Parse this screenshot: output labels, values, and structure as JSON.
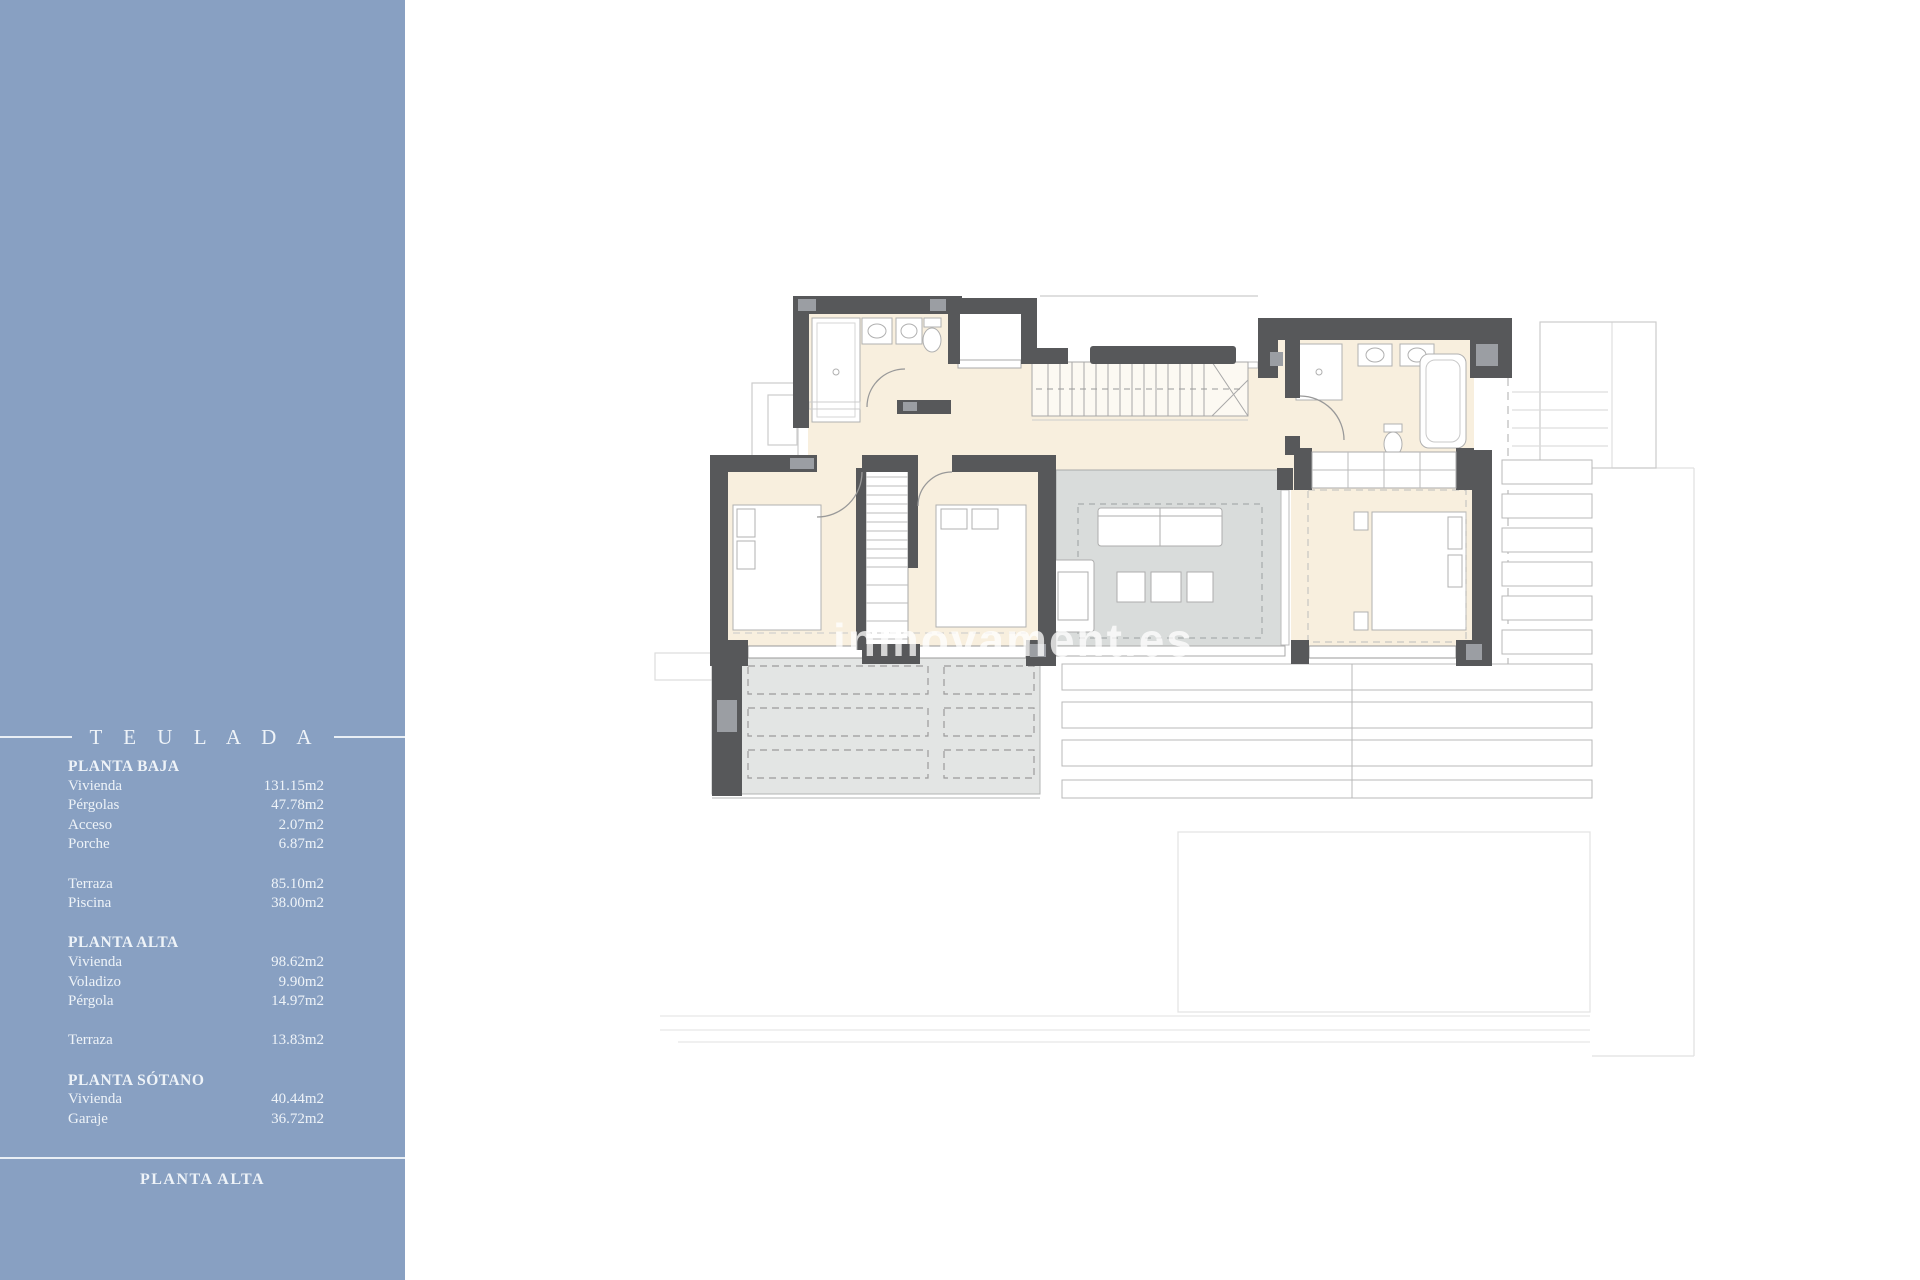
{
  "sidebar": {
    "header": "T E U L A D A",
    "sections": [
      {
        "title": "PLANTA BAJA",
        "items": [
          {
            "label": "Vivienda",
            "value": "131.15m2"
          },
          {
            "label": "Pérgolas",
            "value": "47.78m2"
          },
          {
            "label": "Acceso",
            "value": "2.07m2"
          },
          {
            "label": "Porche",
            "value": "6.87m2"
          }
        ]
      },
      {
        "title": "",
        "items": [
          {
            "label": "Terraza",
            "value": "85.10m2"
          },
          {
            "label": "Piscina",
            "value": "38.00m2"
          }
        ]
      },
      {
        "title": "PLANTA ALTA",
        "items": [
          {
            "label": "Vivienda",
            "value": "98.62m2"
          },
          {
            "label": "Voladizo",
            "value": "9.90m2"
          },
          {
            "label": "Pérgola",
            "value": "14.97m2"
          }
        ]
      },
      {
        "title": "",
        "items": [
          {
            "label": "Terraza",
            "value": "13.83m2"
          }
        ]
      },
      {
        "title": "PLANTA SÓTANO",
        "items": [
          {
            "label": "Vivienda",
            "value": "40.44m2"
          },
          {
            "label": "Garaje",
            "value": "36.72m2"
          }
        ]
      }
    ],
    "footer": "PLANTA ALTA"
  },
  "plan": {
    "watermark": "inmovament.es",
    "floor_shown": "PLANTA ALTA"
  },
  "colors": {
    "sidebar_bg": "#88a0c2",
    "sidebar_text": "#eef3f8",
    "wall": "#57585a",
    "wall_cap": "#9b9ea3",
    "floor_cream": "#f8efde",
    "living_gray": "#d9dcdb",
    "terrace_gray": "#e3e5e4",
    "outline_gray": "#b8b8b8",
    "watermark": "#ffffff"
  }
}
